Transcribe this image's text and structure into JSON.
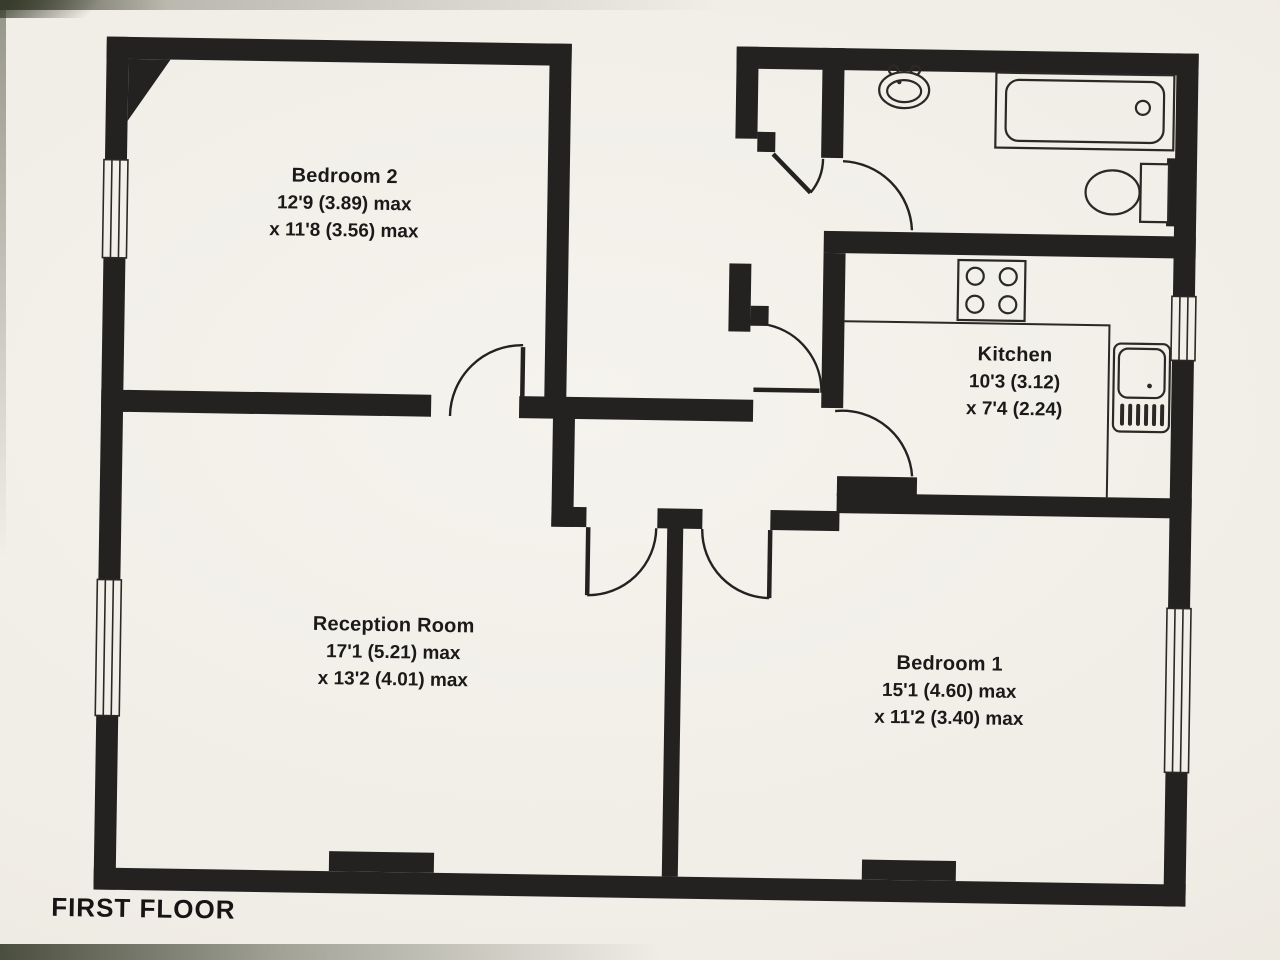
{
  "floorplan": {
    "title": "FIRST FLOOR",
    "rooms": [
      {
        "name": "Bedroom 2",
        "dims": [
          "12'9 (3.89) max",
          "x 11'8 (3.56) max"
        ]
      },
      {
        "name": "Kitchen",
        "dims": [
          "10'3 (3.12)",
          "x 7'4 (2.24)"
        ]
      },
      {
        "name": "Reception Room",
        "dims": [
          "17'1 (5.21) max",
          "x 13'2 (4.01) max"
        ]
      },
      {
        "name": "Bedroom 1",
        "dims": [
          "15'1 (4.60) max",
          "x 11'2 (3.40) max"
        ]
      }
    ],
    "fixtures": [
      "bathtub",
      "wash-basin",
      "toilet",
      "hob",
      "kitchen-sink",
      "worktop"
    ],
    "colors": {
      "wall_ink": "#242220",
      "line_ink": "#2b2925",
      "paper": "#f2efe9"
    }
  }
}
